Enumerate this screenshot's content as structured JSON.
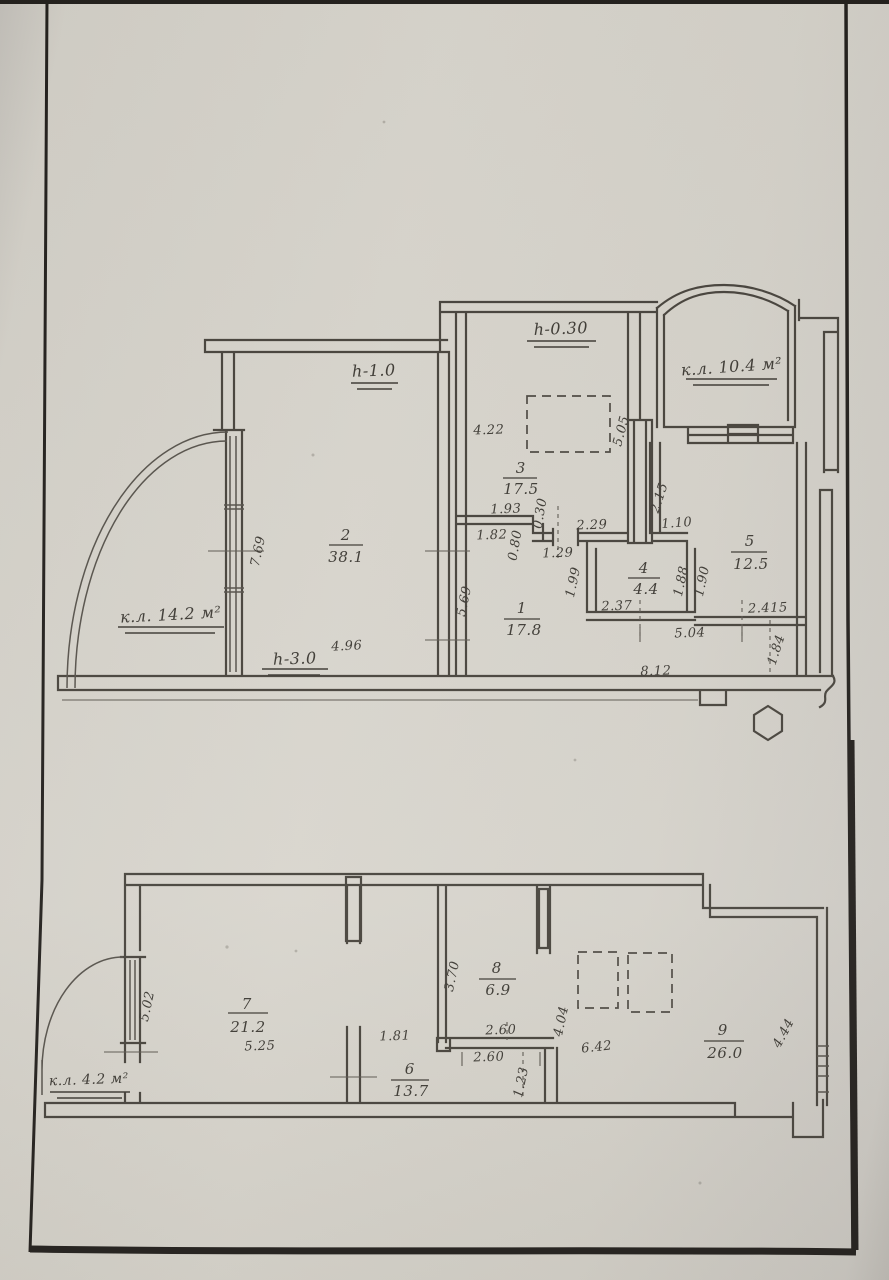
{
  "document": {
    "kind": "scanned technical passport floor plan, two plans on one sheet"
  },
  "upper": {
    "rooms": {
      "r1": {
        "num": "1",
        "area": "17.8"
      },
      "r2": {
        "num": "2",
        "area": "38.1"
      },
      "r3": {
        "num": "3",
        "area": "17.5"
      },
      "r4": {
        "num": "4",
        "area": "4.4"
      },
      "r5": {
        "num": "5",
        "area": "12.5"
      }
    },
    "heights": {
      "room2": "h-1.0",
      "room3": "h-0.30",
      "entry": "h-3.0"
    },
    "loggias": {
      "left": "к.л. 14.2 м²",
      "right": "к.л. 10.4 м²"
    },
    "dims": {
      "d769": "7.69",
      "d496": "4.96",
      "d422": "4.22",
      "d505": "5.05",
      "d193": "1.93",
      "d182": "1.82",
      "d030": "0.30",
      "d080": "0.80",
      "d129": "1.29",
      "d229": "2.29",
      "d110": "1.10",
      "d215": "2.15",
      "d569": "5.69",
      "d199": "1.99",
      "d237": "2.37",
      "d188": "1.88",
      "d190": "1.90",
      "d504": "5.04",
      "d2415": "2.415",
      "d184": "1.84",
      "d812": "8.12"
    }
  },
  "lower": {
    "rooms": {
      "r6": {
        "num": "6",
        "area": "13.7"
      },
      "r7": {
        "num": "7",
        "area": "21.2"
      },
      "r8": {
        "num": "8",
        "area": "6.9"
      },
      "r9": {
        "num": "9",
        "area": "26.0"
      }
    },
    "loggias": {
      "left": "к.л. 4.2 м²"
    },
    "dims": {
      "d502": "5.02",
      "d525": "5.25",
      "d181": "1.81",
      "d370": "3.70",
      "d260a": "2.60",
      "d260b": "2.60",
      "d123": "1.23",
      "d404": "4.04",
      "d642": "6.42",
      "d444": "4.44"
    }
  }
}
